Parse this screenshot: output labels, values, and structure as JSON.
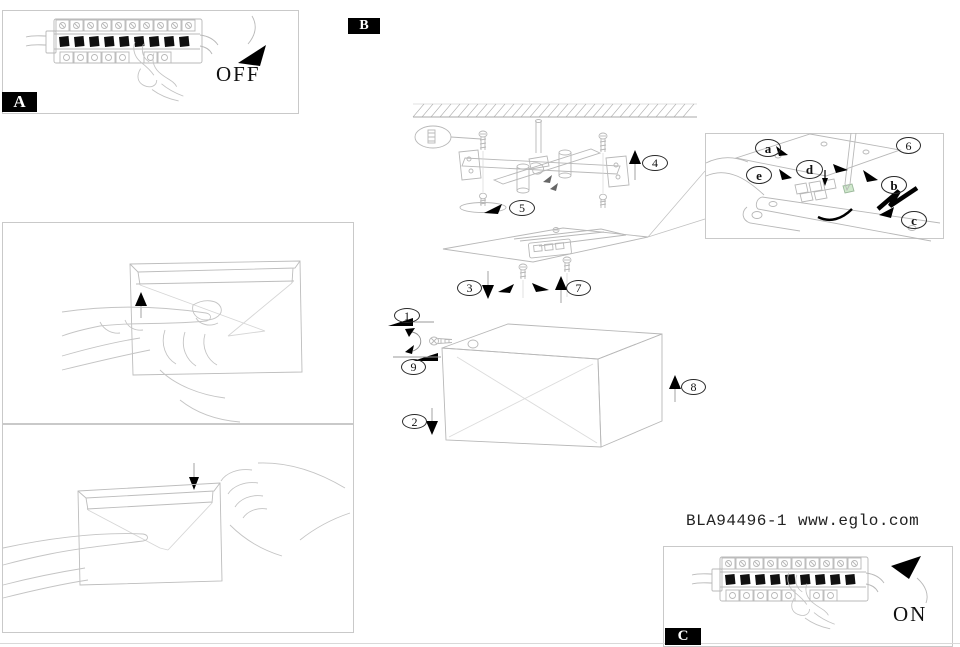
{
  "document": {
    "model_code": "BLA94496-1",
    "website": "www.eglo.com"
  },
  "sections": {
    "a": {
      "label": "A",
      "state": "OFF"
    },
    "b": {
      "label": "B"
    },
    "c": {
      "label": "C",
      "state": "ON"
    }
  },
  "steps": {
    "s1": "1",
    "s2": "2",
    "s3": "3",
    "s4": "4",
    "s5": "5",
    "s6": "6",
    "s7": "7",
    "s8": "8",
    "s9": "9"
  },
  "parts": {
    "a": "a",
    "b": "b",
    "c": "c",
    "d": "d",
    "e": "e"
  },
  "colors": {
    "ink": "#000000",
    "line": "#b8b8b8",
    "accent_green": "#cfe8cc"
  },
  "icons": {
    "off_arrow": "solid-triangle-down-left",
    "on_arrow": "solid-triangle-up-right",
    "up_arrow": "solid-triangle-up",
    "down_arrow": "solid-triangle-down",
    "left_arrow": "solid-triangle-left"
  }
}
